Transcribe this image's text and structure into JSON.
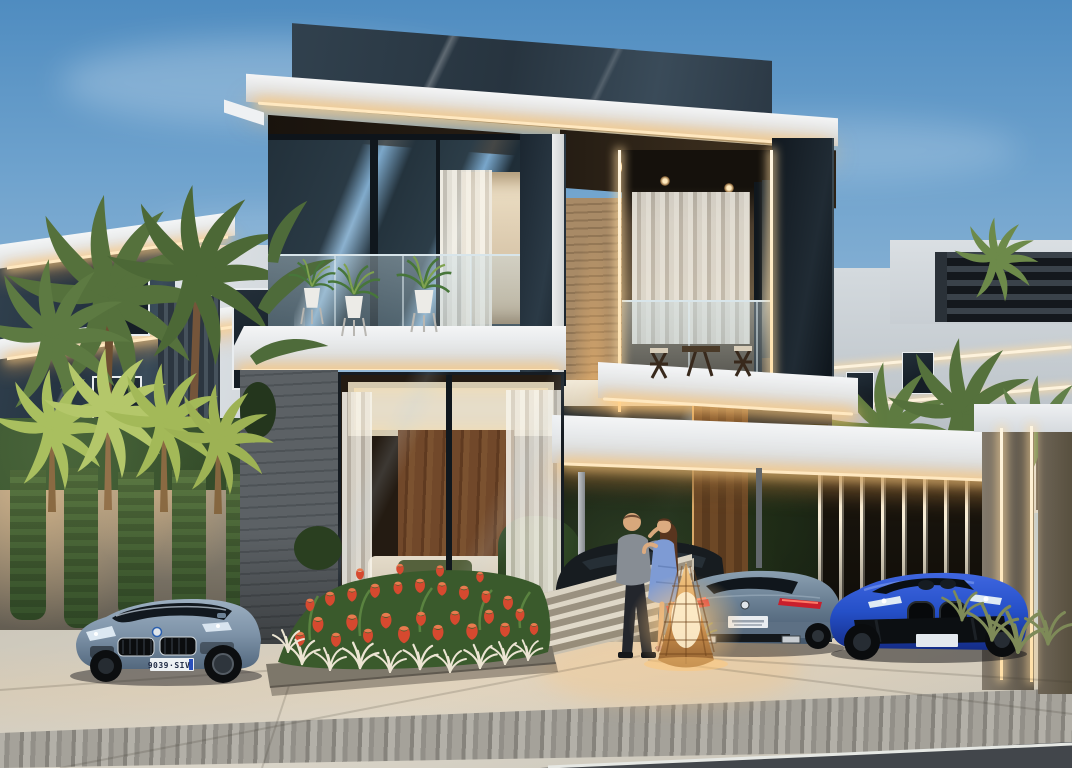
{
  "meta": {
    "title": "Luxury modern villa at dusk — photorealistic architectural visualization",
    "time_of_day": "dusk"
  },
  "scene": {
    "main_villa": {
      "floors": 2,
      "features": [
        "flat white roof slabs with warm LED strip lighting",
        "dark marble crown panel",
        "floor-to-ceiling glazing",
        "glass balustrade balconies with potted plants",
        "outdoor dining set on balcony",
        "white sheer curtains",
        "wood plank accent walls",
        "grey stone clad wall",
        "carport with illuminated vertical slat wall",
        "wooden entry door",
        "stone entry steps"
      ]
    },
    "neighborhood": {
      "left": "white villa with dark marble panel, slat facade and palm trees",
      "right": "white villa with rooftop slat pergola and palm trees"
    },
    "landscape": [
      "underlit palm trees",
      "clipped hedges",
      "cascading vine wall",
      "red tulip flowerbed with white feather grass",
      "ornamental grasses",
      "white flowering shrub"
    ],
    "people": {
      "description": "embracing couple beside a glowing wicker floor lamp",
      "man": "grey shirt, dark trousers",
      "woman": "blue dress, long brown hair"
    }
  },
  "vehicles": {
    "left_car": {
      "type": "grey-blue luxury coupe, front view",
      "body_color": "#7e93a8",
      "plate": "9039·SIV"
    },
    "middle_car": {
      "type": "grey-blue luxury coupe, rear view",
      "body_color": "#64798d",
      "plate": ""
    },
    "right_car": {
      "type": "vivid blue sports convertible, front view",
      "body_color": "#2550c8",
      "plate": ""
    }
  },
  "palette": {
    "sky_top": "#4f8cc0",
    "sky_horizon": "#c9d6e0",
    "led_warm": "#ffd9a4",
    "roof_white": "#eef1f3",
    "marble_dark": "#2c3a46",
    "glass_dark": "#1d2a33",
    "wood": "#6e4a2a",
    "stone_wall": "#53585c",
    "hedge_green": "#3a5230",
    "tulip_red": "#d6492f",
    "pavement": "#d3cec2",
    "lamp_glow": "#ffc87e"
  }
}
